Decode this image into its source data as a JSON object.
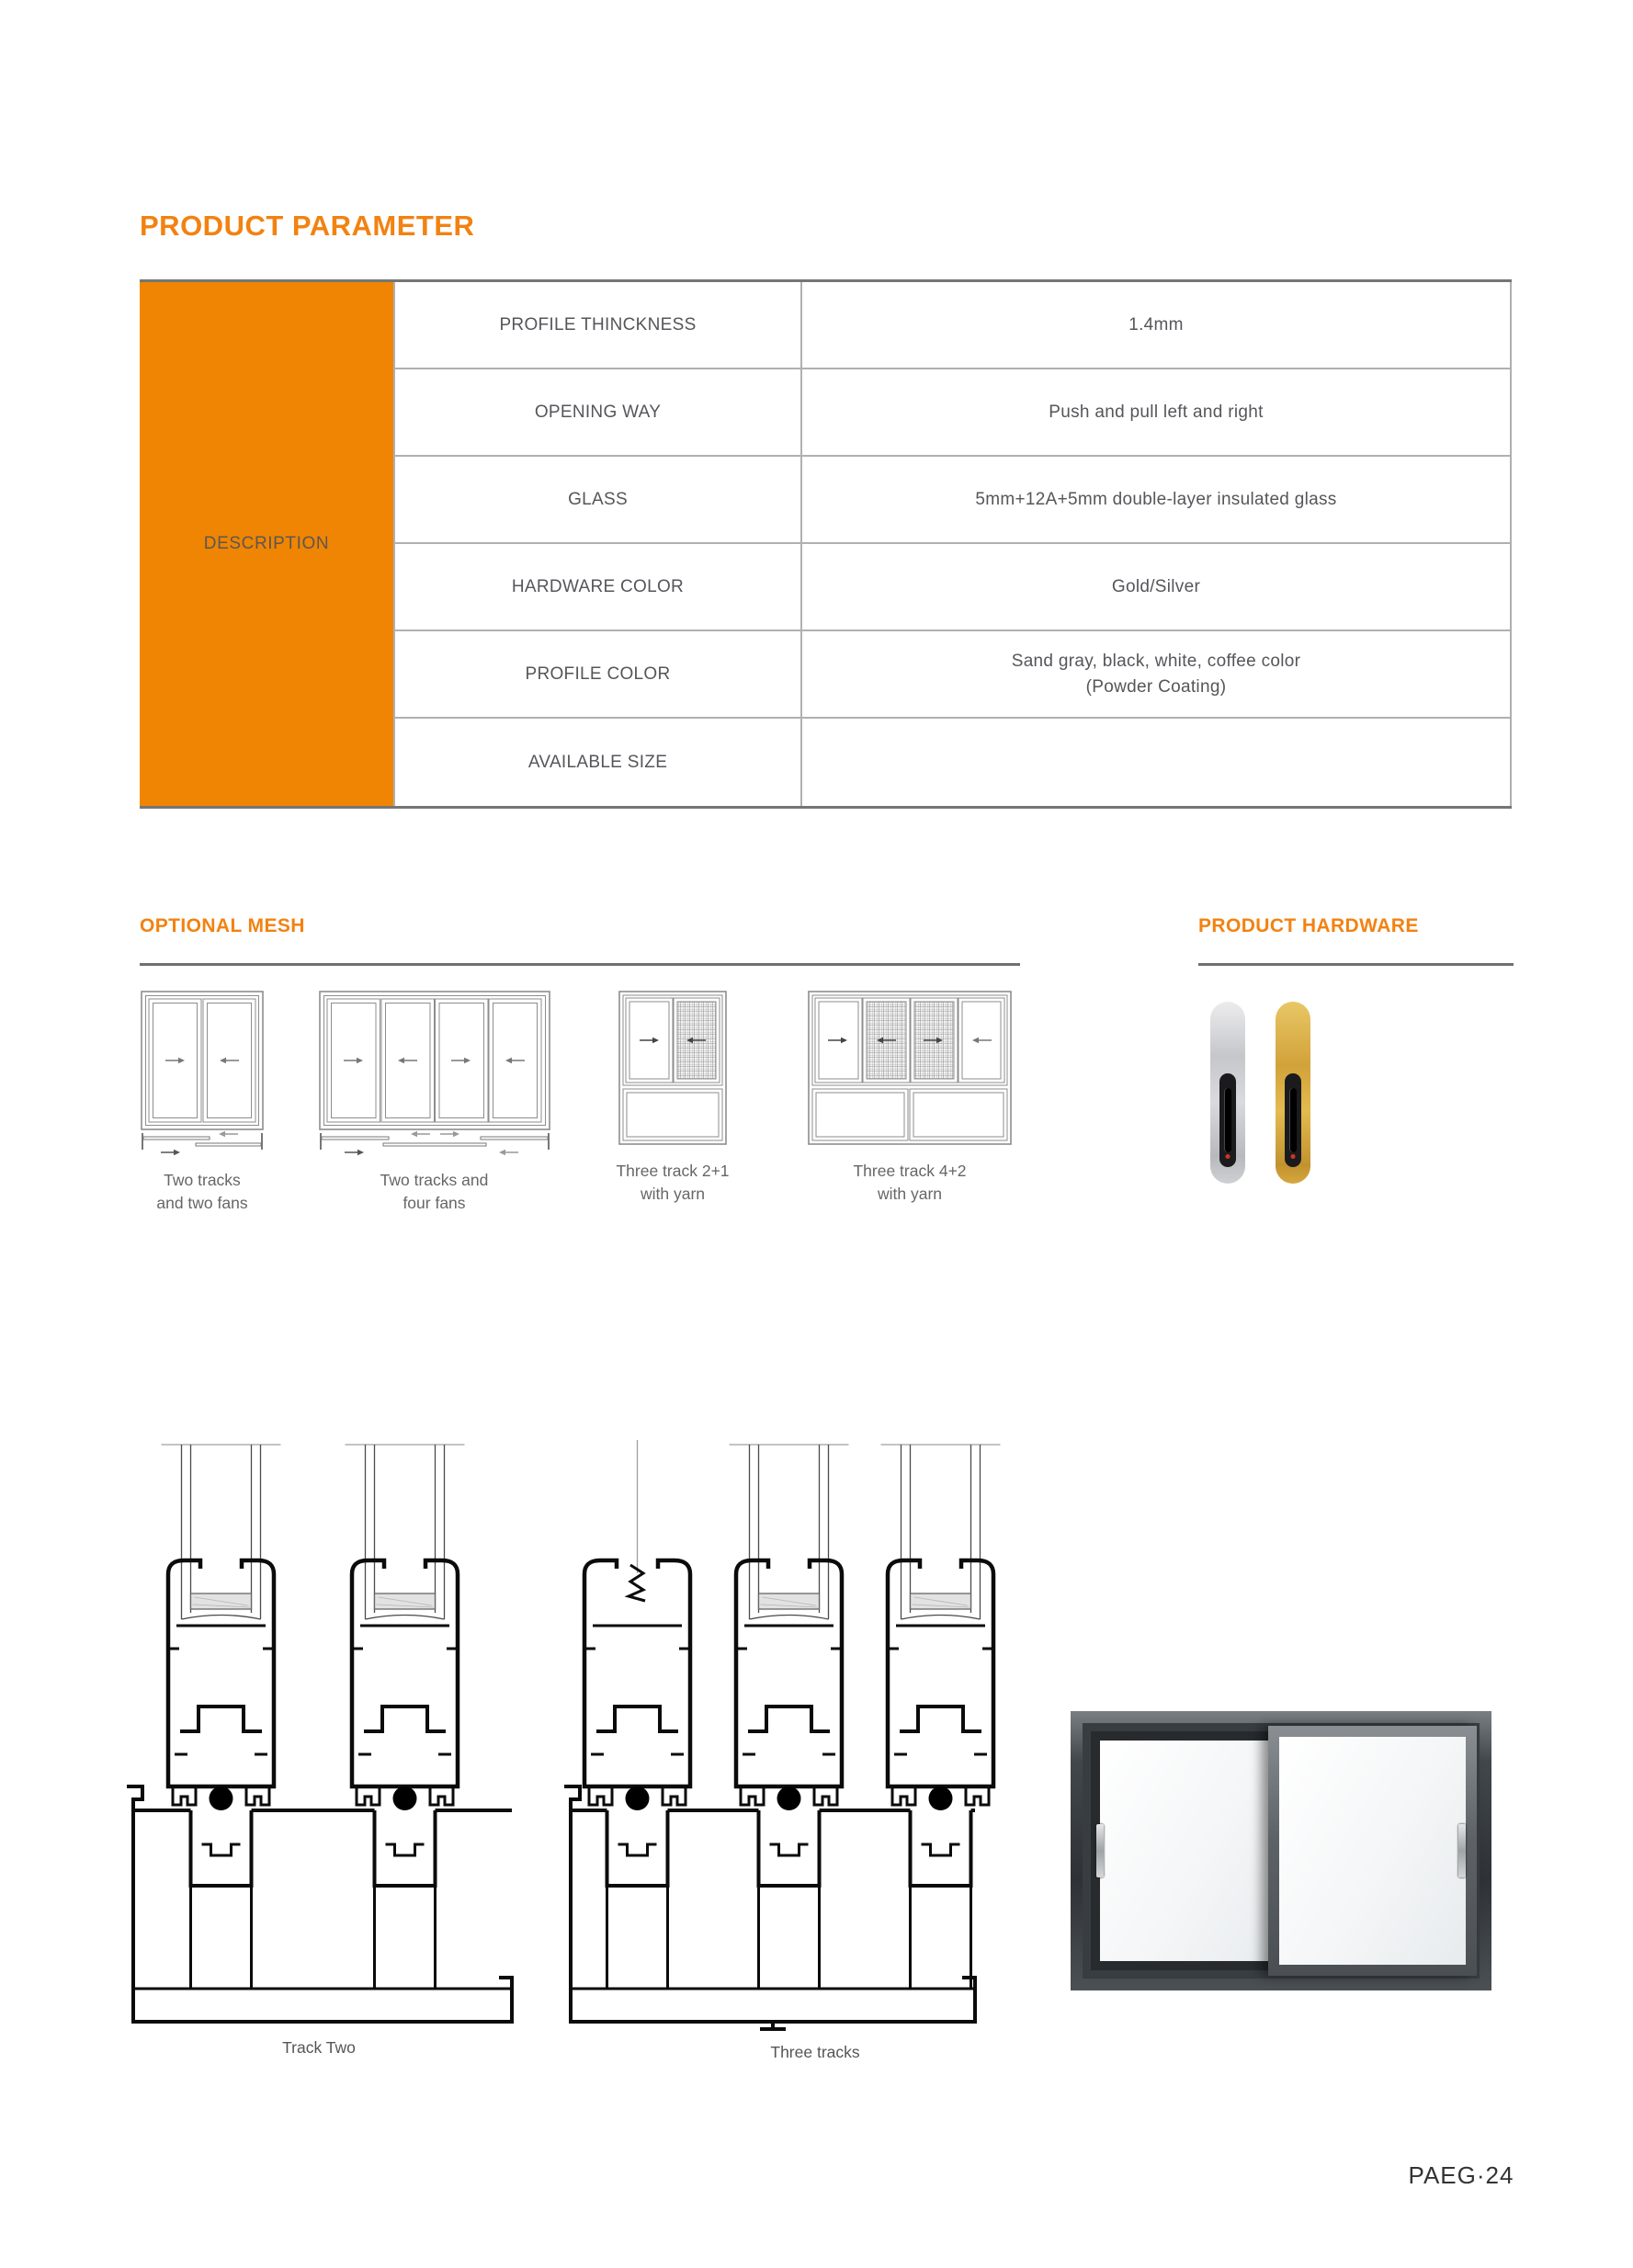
{
  "page": {
    "title": "PRODUCT PARAMETER",
    "page_number": "PAEG·24",
    "background_color": "#ffffff",
    "accent_color": "#F28211",
    "table_header_fill": "#EF8503"
  },
  "parameter_table": {
    "header": "DESCRIPTION",
    "rows": [
      {
        "label": "PROFILE THINCKNESS",
        "value": "1.4mm"
      },
      {
        "label": "OPENING WAY",
        "value": "Push and pull left and right"
      },
      {
        "label": "GLASS",
        "value": "5mm+12A+5mm double-layer insulated glass"
      },
      {
        "label": "HARDWARE COLOR",
        "value": "Gold/Silver"
      },
      {
        "label": "PROFILE COLOR",
        "value": "Sand gray, black, white, coffee color\n(Powder Coating)"
      },
      {
        "label": "AVAILABLE SIZE",
        "value": ""
      }
    ]
  },
  "optional_mesh": {
    "title": "OPTIONAL MESH",
    "items": [
      {
        "caption": "Two tracks\nand two fans",
        "icon": "two-track-two-fan-window-diagram"
      },
      {
        "caption": "Two tracks and\nfour fans",
        "icon": "two-track-four-fan-window-diagram"
      },
      {
        "caption": "Three track 2+1\nwith yarn",
        "icon": "three-track-2plus1-mesh-window-diagram"
      },
      {
        "caption": "Three track 4+2\nwith yarn",
        "icon": "three-track-4plus2-mesh-window-diagram"
      }
    ]
  },
  "product_hardware": {
    "title": "PRODUCT HARDWARE",
    "handles": [
      {
        "name": "silver-handle-lock",
        "color": "#c9cacd"
      },
      {
        "name": "gold-handle-lock",
        "color": "#d8a845"
      }
    ]
  },
  "cross_sections": {
    "labels": [
      "Track Two",
      "Three tracks"
    ]
  }
}
